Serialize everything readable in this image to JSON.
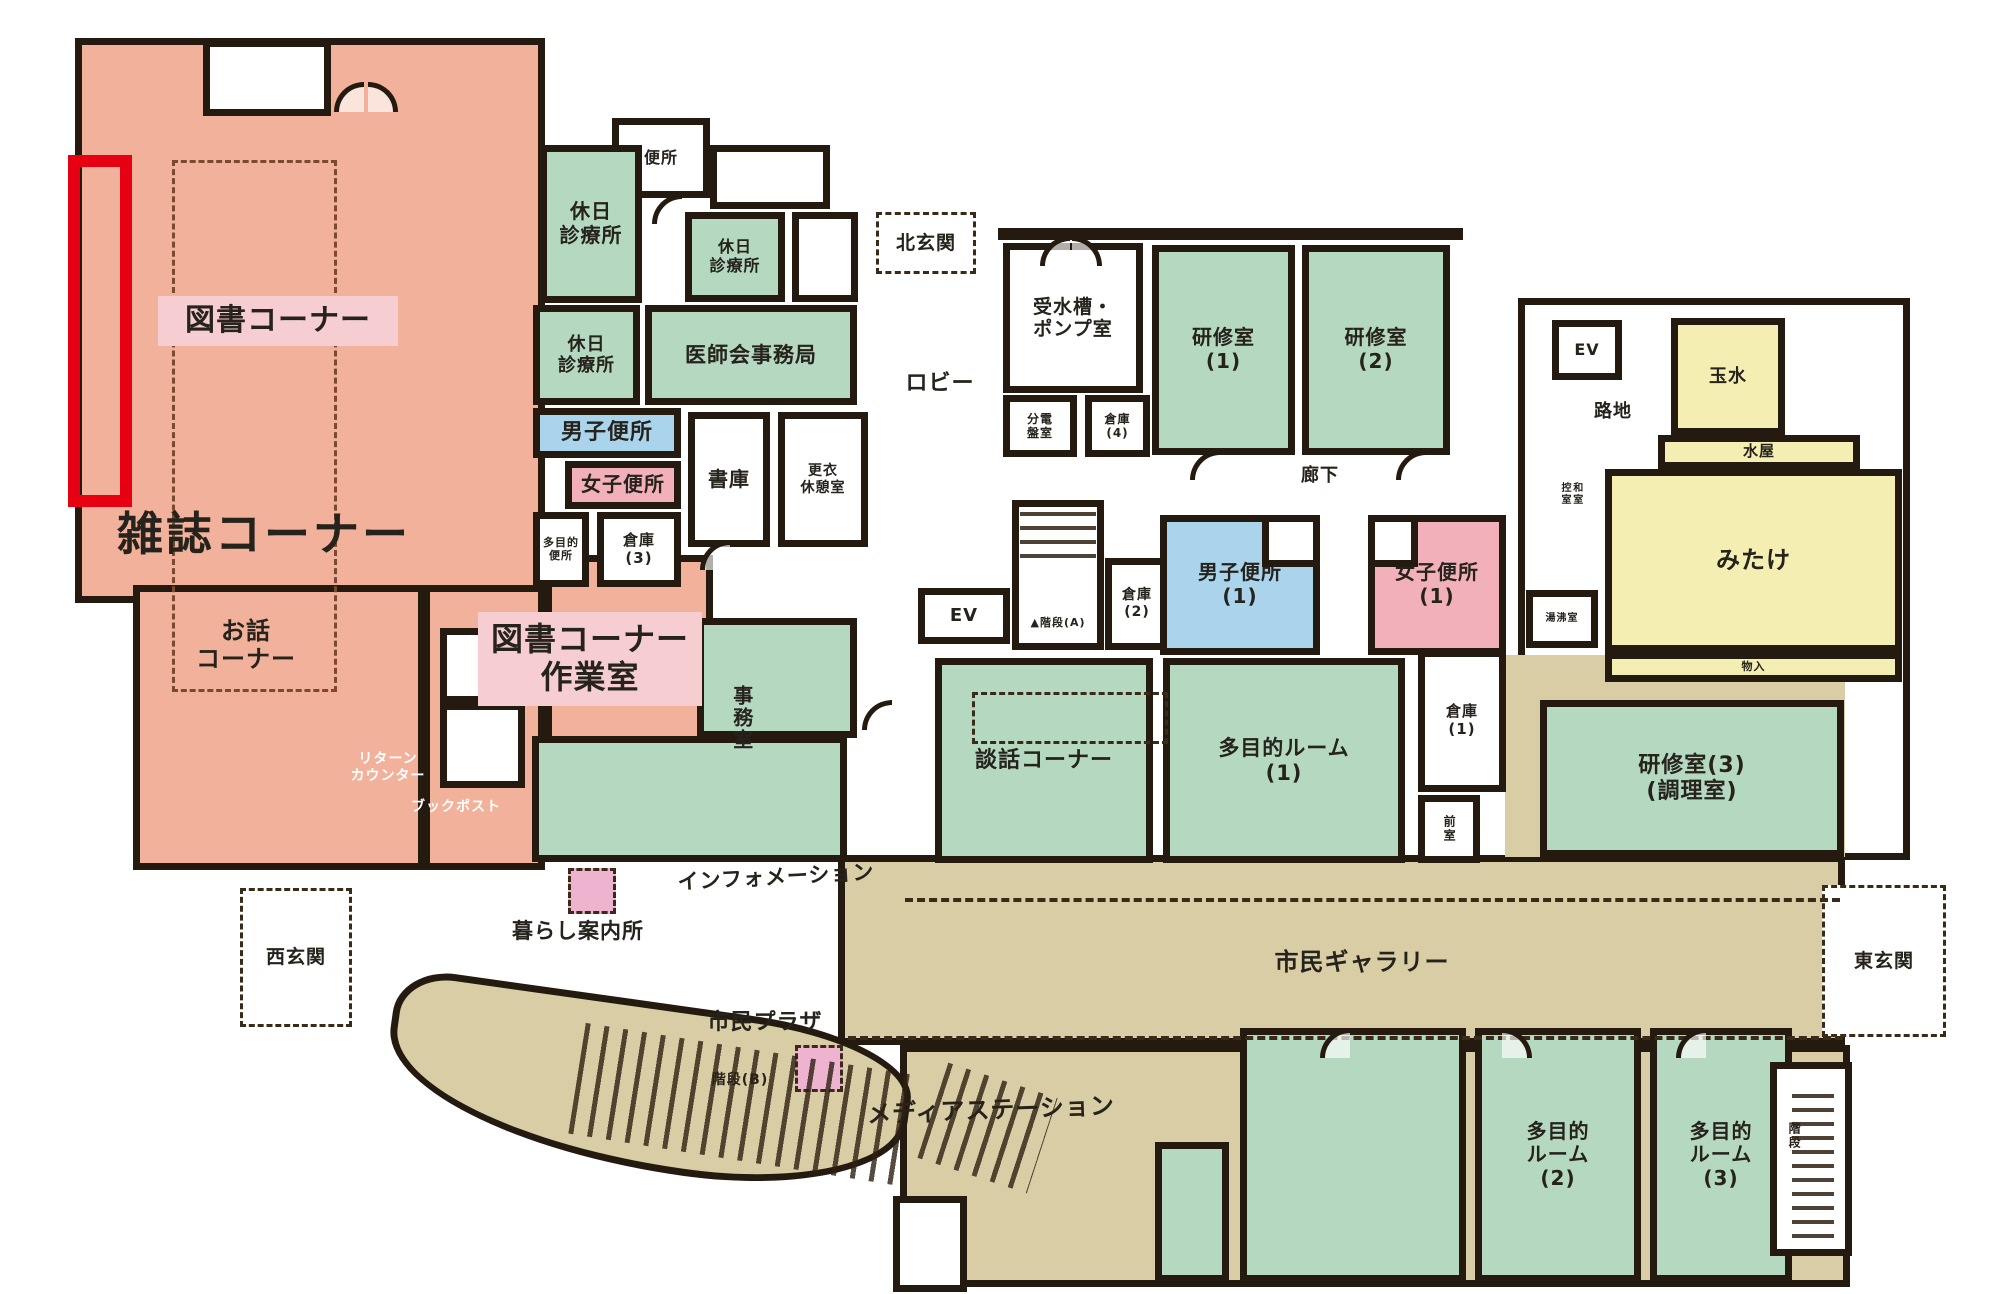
{
  "title": "community-center-first-floor-plan",
  "colors": {
    "wall": "#241a10",
    "dash": "#3a2a18",
    "dash2": "#7a4a30",
    "salmon": "#f2b19a",
    "green": "#b4d8c0",
    "blue": "#a9d4ec",
    "pink": "#f2b0ba",
    "yellow": "#f5eeb2",
    "tan": "#d8cda4",
    "white": "#ffffff",
    "chip": "#f6cdd1",
    "pinksq": "#edb3cf",
    "highlight_red": "#e60012"
  },
  "areas": [
    {
      "name": "zone-library-magazine-area",
      "x": 75,
      "y": 38,
      "w": 470,
      "h": 565,
      "fill": "salmon",
      "border": "wall"
    },
    {
      "name": "room-story-corner",
      "x": 133,
      "y": 585,
      "w": 292,
      "h": 285,
      "fill": "salmon",
      "border": "wall"
    },
    {
      "name": "zone-library-corridor",
      "x": 423,
      "y": 585,
      "w": 122,
      "h": 285,
      "fill": "salmon",
      "border": "wall"
    },
    {
      "name": "room-library-workroom",
      "x": 545,
      "y": 555,
      "w": 168,
      "h": 198,
      "fill": "salmon",
      "border": "wall"
    },
    {
      "name": "zone-gallery-east",
      "x": 838,
      "y": 855,
      "w": 1007,
      "h": 190,
      "fill": "tan",
      "border": "wall"
    },
    {
      "name": "zone-media-south",
      "x": 900,
      "y": 1045,
      "w": 950,
      "h": 242,
      "fill": "tan",
      "border": "wall"
    },
    {
      "name": "zone-walkway-curve",
      "x": 385,
      "y": 1002,
      "w": 525,
      "h": 168,
      "fill": "tan",
      "border": "wall",
      "cls": "curve",
      "rot": 8
    },
    {
      "name": "zone-right-wing",
      "x": 1518,
      "y": 298,
      "w": 392,
      "h": 562,
      "fill": "white",
      "border": "wall"
    },
    {
      "name": "zone-east-corridor",
      "x": 1505,
      "y": 655,
      "w": 340,
      "h": 202,
      "fill": "tan"
    },
    {
      "name": "room-north-notch",
      "x": 203,
      "y": 40,
      "w": 128,
      "h": 76,
      "fill": "white",
      "border": "wall"
    },
    {
      "name": "nook-return-counter",
      "x": 440,
      "y": 628,
      "w": 85,
      "h": 75,
      "fill": "white",
      "border": "wall"
    },
    {
      "name": "nook-book-post",
      "x": 440,
      "y": 703,
      "w": 85,
      "h": 85,
      "fill": "white",
      "border": "wall"
    },
    {
      "name": "room-toilet-north",
      "x": 612,
      "y": 118,
      "w": 98,
      "h": 80,
      "fill": "white",
      "border": "wall",
      "label": "便所",
      "fs": 16
    },
    {
      "name": "room-holiday-clinic-1",
      "x": 540,
      "y": 145,
      "w": 102,
      "h": 158,
      "fill": "green",
      "border": "wall",
      "label": "休日\n診療所",
      "fs": 20
    },
    {
      "name": "room-white-a",
      "x": 710,
      "y": 145,
      "w": 120,
      "h": 64,
      "fill": "white",
      "border": "wall"
    },
    {
      "name": "room-holiday-clinic-2",
      "x": 685,
      "y": 212,
      "w": 100,
      "h": 90,
      "fill": "green",
      "border": "wall",
      "label": "休日\n診療所",
      "fs": 16
    },
    {
      "name": "room-white-b",
      "x": 792,
      "y": 212,
      "w": 66,
      "h": 90,
      "fill": "white",
      "border": "wall"
    },
    {
      "name": "room-holiday-clinic-3",
      "x": 533,
      "y": 305,
      "w": 107,
      "h": 100,
      "fill": "green",
      "border": "wall",
      "label": "休日\n診療所",
      "fs": 18
    },
    {
      "name": "room-medical-association-office",
      "x": 645,
      "y": 305,
      "w": 212,
      "h": 100,
      "fill": "green",
      "border": "wall",
      "label": "医師会事務局",
      "fs": 21
    },
    {
      "name": "room-mens-toilet-west",
      "x": 533,
      "y": 408,
      "w": 148,
      "h": 50,
      "fill": "blue",
      "border": "wall",
      "label": "男子便所",
      "fs": 22
    },
    {
      "name": "room-womens-toilet-west",
      "x": 565,
      "y": 461,
      "w": 116,
      "h": 48,
      "fill": "pink",
      "border": "wall",
      "label": "女子便所",
      "fs": 20
    },
    {
      "name": "room-stack-room",
      "x": 688,
      "y": 412,
      "w": 82,
      "h": 135,
      "fill": "white",
      "border": "wall",
      "label": "書庫",
      "fs": 20
    },
    {
      "name": "room-changing-rest-room",
      "x": 778,
      "y": 412,
      "w": 90,
      "h": 135,
      "fill": "white",
      "border": "wall",
      "label": "更衣\n休憩室",
      "fs": 14
    },
    {
      "name": "room-multipurpose-toilet",
      "x": 533,
      "y": 512,
      "w": 56,
      "h": 75,
      "fill": "white",
      "border": "wall",
      "label": "多目的\n便所",
      "fs": 11
    },
    {
      "name": "room-storage-3",
      "x": 597,
      "y": 512,
      "w": 84,
      "h": 75,
      "fill": "white",
      "border": "wall",
      "label": "倉庫\n(3)",
      "fs": 15
    },
    {
      "name": "room-office-upper",
      "x": 697,
      "y": 618,
      "w": 160,
      "h": 120,
      "fill": "green",
      "border": "wall"
    },
    {
      "name": "room-office-lower",
      "x": 532,
      "y": 736,
      "w": 315,
      "h": 126,
      "fill": "green",
      "border": "wall"
    },
    {
      "name": "label-office",
      "x": 720,
      "y": 650,
      "w": 42,
      "h": 135,
      "label": "事務室",
      "fs": 20,
      "vert": 1
    },
    {
      "name": "room-north-entrance",
      "x": 876,
      "y": 212,
      "w": 100,
      "h": 62,
      "fill": "white",
      "border": "dash",
      "label": "北玄関",
      "fs": 19
    },
    {
      "name": "label-lobby",
      "x": 885,
      "y": 368,
      "w": 110,
      "h": 32,
      "label": "ロビー",
      "fs": 22
    },
    {
      "name": "room-ev-west",
      "x": 918,
      "y": 588,
      "w": 92,
      "h": 56,
      "fill": "white",
      "border": "wall",
      "label": "EV",
      "fs": 18
    },
    {
      "name": "room-stairs-a",
      "x": 1012,
      "y": 500,
      "w": 92,
      "h": 150,
      "fill": "white",
      "border": "wall"
    },
    {
      "name": "label-stairs-a",
      "x": 1012,
      "y": 612,
      "w": 92,
      "h": 22,
      "label": "▲階段(A)",
      "fs": 11
    },
    {
      "name": "room-storage-2",
      "x": 1105,
      "y": 558,
      "w": 64,
      "h": 92,
      "fill": "white",
      "border": "wall",
      "label": "倉庫\n(2)",
      "fs": 14
    },
    {
      "name": "room-conversation-corner",
      "x": 935,
      "y": 658,
      "w": 218,
      "h": 205,
      "fill": "green",
      "border": "wall",
      "label": "談話コーナー",
      "fs": 22
    },
    {
      "name": "room-multipurpose-1",
      "x": 1163,
      "y": 658,
      "w": 242,
      "h": 205,
      "fill": "green",
      "border": "wall",
      "label": "多目的ルーム\n(1)",
      "fs": 21
    },
    {
      "name": "room-storage-1",
      "x": 1418,
      "y": 650,
      "w": 88,
      "h": 142,
      "fill": "white",
      "border": "wall",
      "label": "倉庫\n(1)",
      "fs": 15
    },
    {
      "name": "room-anteroom",
      "x": 1418,
      "y": 795,
      "w": 62,
      "h": 68,
      "fill": "white",
      "border": "wall",
      "label": "前室",
      "fs": 12,
      "vert": 1
    },
    {
      "name": "room-water-tank-pump",
      "x": 1003,
      "y": 243,
      "w": 140,
      "h": 150,
      "fill": "white",
      "border": "wall",
      "label": "受水槽・\nポンプ室",
      "fs": 19
    },
    {
      "name": "room-distribution-board",
      "x": 1003,
      "y": 395,
      "w": 74,
      "h": 62,
      "fill": "white",
      "border": "wall",
      "label": "分電\n盤室",
      "fs": 12
    },
    {
      "name": "room-storage-4",
      "x": 1085,
      "y": 395,
      "w": 65,
      "h": 62,
      "fill": "white",
      "border": "wall",
      "label": "倉庫\n(4)",
      "fs": 12
    },
    {
      "name": "room-training-1",
      "x": 1152,
      "y": 245,
      "w": 143,
      "h": 210,
      "fill": "green",
      "border": "wall",
      "label": "研修室\n(1)",
      "fs": 20
    },
    {
      "name": "room-training-2",
      "x": 1302,
      "y": 245,
      "w": 148,
      "h": 210,
      "fill": "green",
      "border": "wall",
      "label": "研修室\n(2)",
      "fs": 20
    },
    {
      "name": "label-corridor",
      "x": 1282,
      "y": 462,
      "w": 76,
      "h": 28,
      "label": "廊下",
      "fs": 18
    },
    {
      "name": "room-mens-toilet-1",
      "x": 1160,
      "y": 515,
      "w": 160,
      "h": 140,
      "fill": "blue",
      "border": "wall",
      "label": "男子便所\n(1)",
      "fs": 20
    },
    {
      "name": "notch-mens-toilet",
      "x": 1262,
      "y": 515,
      "w": 58,
      "h": 52,
      "fill": "white",
      "border": "wall"
    },
    {
      "name": "room-womens-toilet-1",
      "x": 1368,
      "y": 515,
      "w": 138,
      "h": 140,
      "fill": "pink",
      "border": "wall",
      "label": "女子便所\n(1)",
      "fs": 20
    },
    {
      "name": "notch-womens-toilet",
      "x": 1368,
      "y": 515,
      "w": 50,
      "h": 52,
      "fill": "white",
      "border": "wall"
    },
    {
      "name": "room-ev-east",
      "x": 1552,
      "y": 320,
      "w": 70,
      "h": 60,
      "fill": "white",
      "border": "wall",
      "label": "EV",
      "fs": 16
    },
    {
      "name": "label-alley",
      "x": 1575,
      "y": 398,
      "w": 76,
      "h": 28,
      "label": "路地",
      "fs": 18
    },
    {
      "name": "label-washitsu-anteroom",
      "x": 1548,
      "y": 445,
      "w": 44,
      "h": 98,
      "label": "和室\n控室",
      "fs": 10,
      "vert": 1
    },
    {
      "name": "room-tamamizu",
      "x": 1671,
      "y": 318,
      "w": 114,
      "h": 117,
      "fill": "yellow",
      "border": "wall",
      "label": "玉水",
      "fs": 18,
      "cls": "tatami"
    },
    {
      "name": "room-mizuya",
      "x": 1658,
      "y": 435,
      "w": 202,
      "h": 34,
      "fill": "yellow",
      "border": "wall",
      "label": "水屋",
      "fs": 15
    },
    {
      "name": "room-mitake",
      "x": 1605,
      "y": 469,
      "w": 297,
      "h": 183,
      "fill": "yellow",
      "border": "wall",
      "label": "みたけ",
      "fs": 24,
      "cls": "tatami"
    },
    {
      "name": "room-storage-closet",
      "x": 1605,
      "y": 652,
      "w": 297,
      "h": 30,
      "fill": "yellow",
      "border": "wall",
      "label": "物入",
      "fs": 11
    },
    {
      "name": "room-water-heating",
      "x": 1526,
      "y": 590,
      "w": 72,
      "h": 58,
      "fill": "white",
      "border": "wall",
      "label": "湯沸室",
      "fs": 10
    },
    {
      "name": "room-training-3",
      "x": 1540,
      "y": 700,
      "w": 304,
      "h": 157,
      "fill": "green",
      "border": "wall",
      "label": "研修室(3)\n(調理室)",
      "fs": 22
    },
    {
      "name": "room-east-entrance",
      "x": 1822,
      "y": 885,
      "w": 124,
      "h": 152,
      "fill": "white",
      "border": "dash",
      "label": "東玄関",
      "fs": 19
    },
    {
      "name": "room-west-entrance",
      "x": 240,
      "y": 888,
      "w": 112,
      "h": 139,
      "fill": "white",
      "border": "dash",
      "label": "西玄関",
      "fs": 19
    },
    {
      "name": "label-story-corner",
      "x": 162,
      "y": 606,
      "w": 168,
      "h": 78,
      "label": "お話\nコーナー",
      "fs": 24
    },
    {
      "name": "label-information",
      "x": 655,
      "y": 862,
      "w": 242,
      "h": 30,
      "label": "インフォメーション",
      "fs": 21,
      "rot": -3
    },
    {
      "name": "label-kurashi-guide",
      "x": 488,
      "y": 916,
      "w": 180,
      "h": 30,
      "label": "暮らし案内所",
      "fs": 21
    },
    {
      "name": "marker-pink-square-1",
      "x": 568,
      "y": 868,
      "w": 48,
      "h": 46,
      "fill": "pinksq",
      "border": "dash"
    },
    {
      "name": "label-civic-plaza",
      "x": 694,
      "y": 1008,
      "w": 142,
      "h": 30,
      "label": "市民プラザ",
      "fs": 22
    },
    {
      "name": "label-stairs-b",
      "x": 692,
      "y": 1068,
      "w": 96,
      "h": 24,
      "label": "階段(B)",
      "fs": 14
    },
    {
      "name": "marker-pink-square-2",
      "x": 795,
      "y": 1045,
      "w": 48,
      "h": 47,
      "fill": "pinksq",
      "border": "dash"
    },
    {
      "name": "label-media-station",
      "x": 850,
      "y": 1094,
      "w": 282,
      "h": 32,
      "label": "メディアステーション",
      "fs": 24,
      "rot": -2
    },
    {
      "name": "label-civic-gallery",
      "x": 1258,
      "y": 946,
      "w": 208,
      "h": 32,
      "label": "市民ギャラリー",
      "fs": 24
    },
    {
      "name": "room-green-large-south",
      "x": 1240,
      "y": 1028,
      "w": 226,
      "h": 254,
      "fill": "green",
      "border": "wall"
    },
    {
      "name": "room-green-small-south",
      "x": 1155,
      "y": 1142,
      "w": 74,
      "h": 140,
      "fill": "green",
      "border": "wall"
    },
    {
      "name": "room-multipurpose-2",
      "x": 1475,
      "y": 1028,
      "w": 166,
      "h": 254,
      "fill": "green",
      "border": "wall",
      "label": "多目的\nルーム\n(2)",
      "fs": 20
    },
    {
      "name": "room-multipurpose-3",
      "x": 1650,
      "y": 1028,
      "w": 142,
      "h": 254,
      "fill": "green",
      "border": "wall",
      "label": "多目的\nルーム\n(3)",
      "fs": 20
    },
    {
      "name": "room-stairs-se",
      "x": 1770,
      "y": 1062,
      "w": 82,
      "h": 194,
      "fill": "white",
      "border": "wall"
    },
    {
      "name": "label-stairs-se",
      "x": 1778,
      "y": 1100,
      "w": 32,
      "h": 72,
      "label": "階段",
      "fs": 12,
      "vert": 1
    },
    {
      "name": "room-south-small",
      "x": 893,
      "y": 1196,
      "w": 74,
      "h": 96,
      "fill": "white",
      "border": "wall"
    },
    {
      "name": "label-return-counter",
      "x": 322,
      "y": 738,
      "w": 132,
      "h": 60,
      "label": "リターン\nカウンター",
      "fs": 14,
      "tc": "#ffffff"
    },
    {
      "name": "label-book-post",
      "x": 385,
      "y": 794,
      "w": 142,
      "h": 26,
      "label": "ブックポスト",
      "fs": 14,
      "tc": "#ffffff"
    },
    {
      "name": "zone-bookshelf-dashed",
      "x": 172,
      "y": 160,
      "w": 165,
      "h": 532,
      "border": "dash2"
    },
    {
      "name": "label-chip-library-corner",
      "x": 158,
      "y": 296,
      "w": 240,
      "h": 50,
      "fill": "chip",
      "label": "図書コーナー",
      "fs": 30
    },
    {
      "name": "label-chip-workroom",
      "x": 478,
      "y": 612,
      "w": 224,
      "h": 94,
      "fill": "chip",
      "label": "図書コーナー\n作業室",
      "fs": 32
    },
    {
      "name": "label-magazine-corner",
      "x": 90,
      "y": 502,
      "w": 348,
      "h": 64,
      "label": "雑誌コーナー",
      "fs": 46,
      "bold": 1
    },
    {
      "name": "marker-red-highlight",
      "x": 68,
      "y": 155,
      "w": 64,
      "h": 352,
      "border": "red"
    }
  ]
}
